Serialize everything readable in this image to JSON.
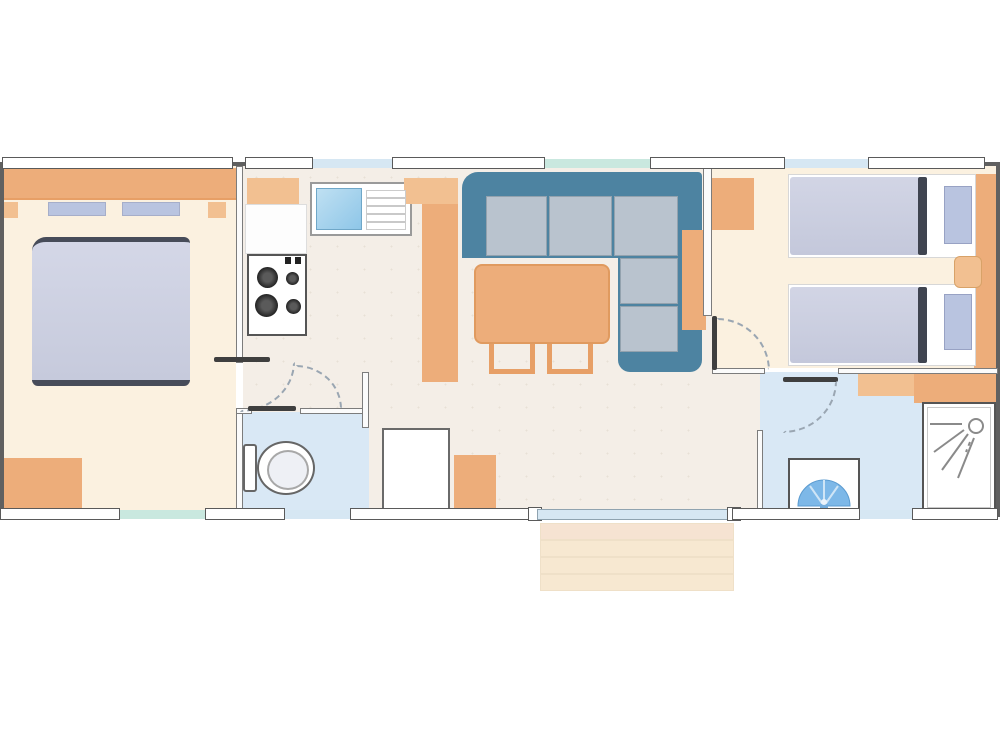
{
  "plan": {
    "name": "mobile-home-floor-plan",
    "rooms": [
      {
        "name": "master-bedroom",
        "furniture": [
          "double-bed",
          "headboard-shelf",
          "pillows",
          "dresser"
        ]
      },
      {
        "name": "kitchen",
        "furniture": [
          "wall-cabinet",
          "worktop",
          "sink-with-drainer",
          "hob-4-burners",
          "fridge-cabinet"
        ]
      },
      {
        "name": "living-dining",
        "furniture": [
          "corner-sofa",
          "dining-table",
          "chairs"
        ]
      },
      {
        "name": "hallway",
        "furniture": [
          "cupboard",
          "cabinet"
        ]
      },
      {
        "name": "wc",
        "furniture": [
          "toilet"
        ]
      },
      {
        "name": "twin-bedroom",
        "furniture": [
          "wardrobe",
          "twin-bed-1",
          "twin-bed-2",
          "nightstand",
          "headboard-panel"
        ]
      },
      {
        "name": "shower-room",
        "furniture": [
          "vanity-counter",
          "shower-cubicle",
          "washbasin"
        ]
      },
      {
        "name": "entrance",
        "furniture": [
          "sliding-patio-door",
          "steps"
        ]
      }
    ],
    "icons": [
      "shower-head-icon",
      "washbasin-icon",
      "toilet-icon",
      "hob-burner-icon"
    ]
  },
  "colors": {
    "wall": "#606060",
    "wall_fill": "#fbfbfb",
    "outline": "#5a5a5a",
    "leaf": "#3f3f3f",
    "floor_cream": "#fbf1e0",
    "floor_pale": "#f4eee7",
    "floor_blue": "#d9e8f5",
    "orange": "#edad7a",
    "orange_light": "#f2c091",
    "orange_deep": "#e79f66",
    "mattress": "#cbcfdf",
    "mattress_edge": "#3f4450",
    "pillow": "#b9c4e0",
    "sofa": "#4d83a1",
    "cushion": "#b9c3ce",
    "sink": "#8ec6e8",
    "basin": "#6fb0e2",
    "glass_blue": "#d6e7f3",
    "glass_teal": "#c9e8df",
    "step": "#f7e8d1"
  }
}
